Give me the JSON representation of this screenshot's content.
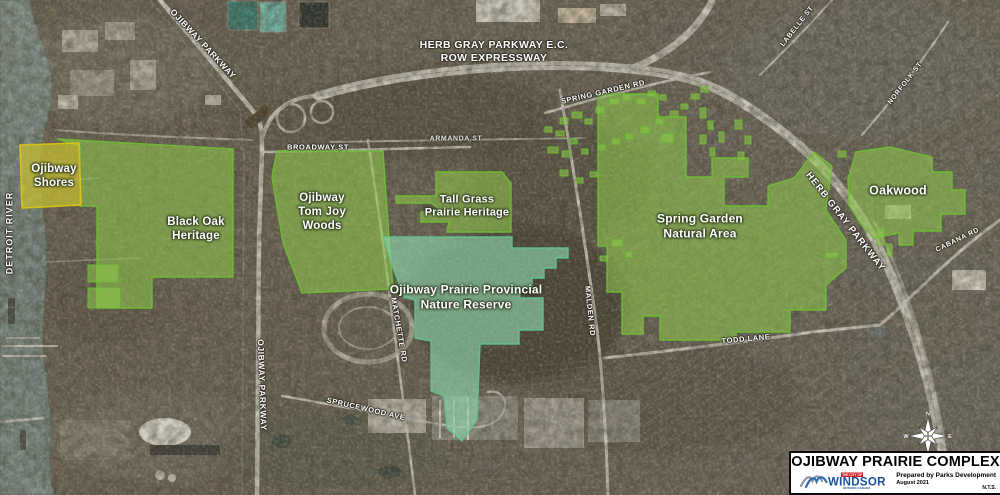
{
  "map": {
    "water_label": "DETROIT RIVER",
    "regions": [
      {
        "id": "ojibway-shores",
        "name": "Ojibway Shores",
        "lines": [
          "Ojibway",
          "Shores"
        ]
      },
      {
        "id": "black-oak-heritage",
        "name": "Black Oak Heritage",
        "lines": [
          "Black Oak",
          "Heritage"
        ]
      },
      {
        "id": "ojibway-tom-joy-woods",
        "name": "Ojibway Tom Joy Woods",
        "lines": [
          "Ojibway",
          "Tom Joy",
          "Woods"
        ]
      },
      {
        "id": "tall-grass-prairie-heritage",
        "name": "Tall Grass Prairie Heritage",
        "lines": [
          "Tall Grass",
          "Prairie Heritage"
        ]
      },
      {
        "id": "ojibway-prairie-provincial-nature-reserve",
        "name": "Ojibway Prairie Provincial Nature Reserve",
        "lines": [
          "Ojibway Prairie Provincial",
          "Nature Reserve"
        ]
      },
      {
        "id": "spring-garden-natural-area",
        "name": "Spring Garden Natural Area",
        "lines": [
          "Spring Garden",
          "Natural Area"
        ]
      },
      {
        "id": "oakwood",
        "name": "Oakwood",
        "lines": [
          "Oakwood"
        ]
      }
    ],
    "roads": [
      {
        "id": "ojibway-parkway-north",
        "label": "OJIBWAY PARKWAY"
      },
      {
        "id": "herb-gray-ec-row",
        "lines": [
          "HERB GRAY PARKWAY E.C.",
          "ROW EXPRESSWAY"
        ]
      },
      {
        "id": "broadway-st",
        "label": "BROADWAY ST"
      },
      {
        "id": "armanda-st",
        "label": "ARMANDA ST"
      },
      {
        "id": "spring-garden-rd",
        "label": "SPRING GARDEN RD"
      },
      {
        "id": "labelle-st",
        "label": "LABELLE ST"
      },
      {
        "id": "norfolk-st",
        "label": "NORFOLK ST"
      },
      {
        "id": "herb-gray-parkway",
        "label": "HERB GRAY PARKWAY"
      },
      {
        "id": "cabana-rd",
        "label": "CABANA RD"
      },
      {
        "id": "matchette-rd",
        "label": "MATCHETTE RD"
      },
      {
        "id": "malden-rd",
        "label": "MALDEN RD"
      },
      {
        "id": "todd-lane",
        "label": "TODD LANE"
      },
      {
        "id": "sprucewood-ave",
        "label": "SPRUCEWOOD AVE"
      },
      {
        "id": "ojibway-parkway-south",
        "label": "OJIBWAY PARKWAY"
      }
    ]
  },
  "compass": {
    "n": "N",
    "e": "E",
    "s": "S",
    "w": "W"
  },
  "title_block": {
    "title": "OJIBWAY PRAIRIE COMPLEX",
    "prepared_by": "Prepared by Parks Development",
    "date": "August 2021",
    "scale": "N.T.S.",
    "logo": {
      "city_of": "THE CITY OF",
      "name": "WINDSOR",
      "subtext": "ONTARIO CANADA"
    }
  },
  "colors": {
    "region_green": "#8fca4d",
    "region_border": "#6fbe33",
    "reserve_teal": "#8fd9ad",
    "reserve_border": "#5fc48c",
    "shores_yellow": "#c6c12f",
    "shores_border": "#d8c319",
    "water": "#808c84",
    "label_text": "#ffffff",
    "title_text": "#000000",
    "logo_blue": "#17509e",
    "logo_red": "#cc2027"
  }
}
